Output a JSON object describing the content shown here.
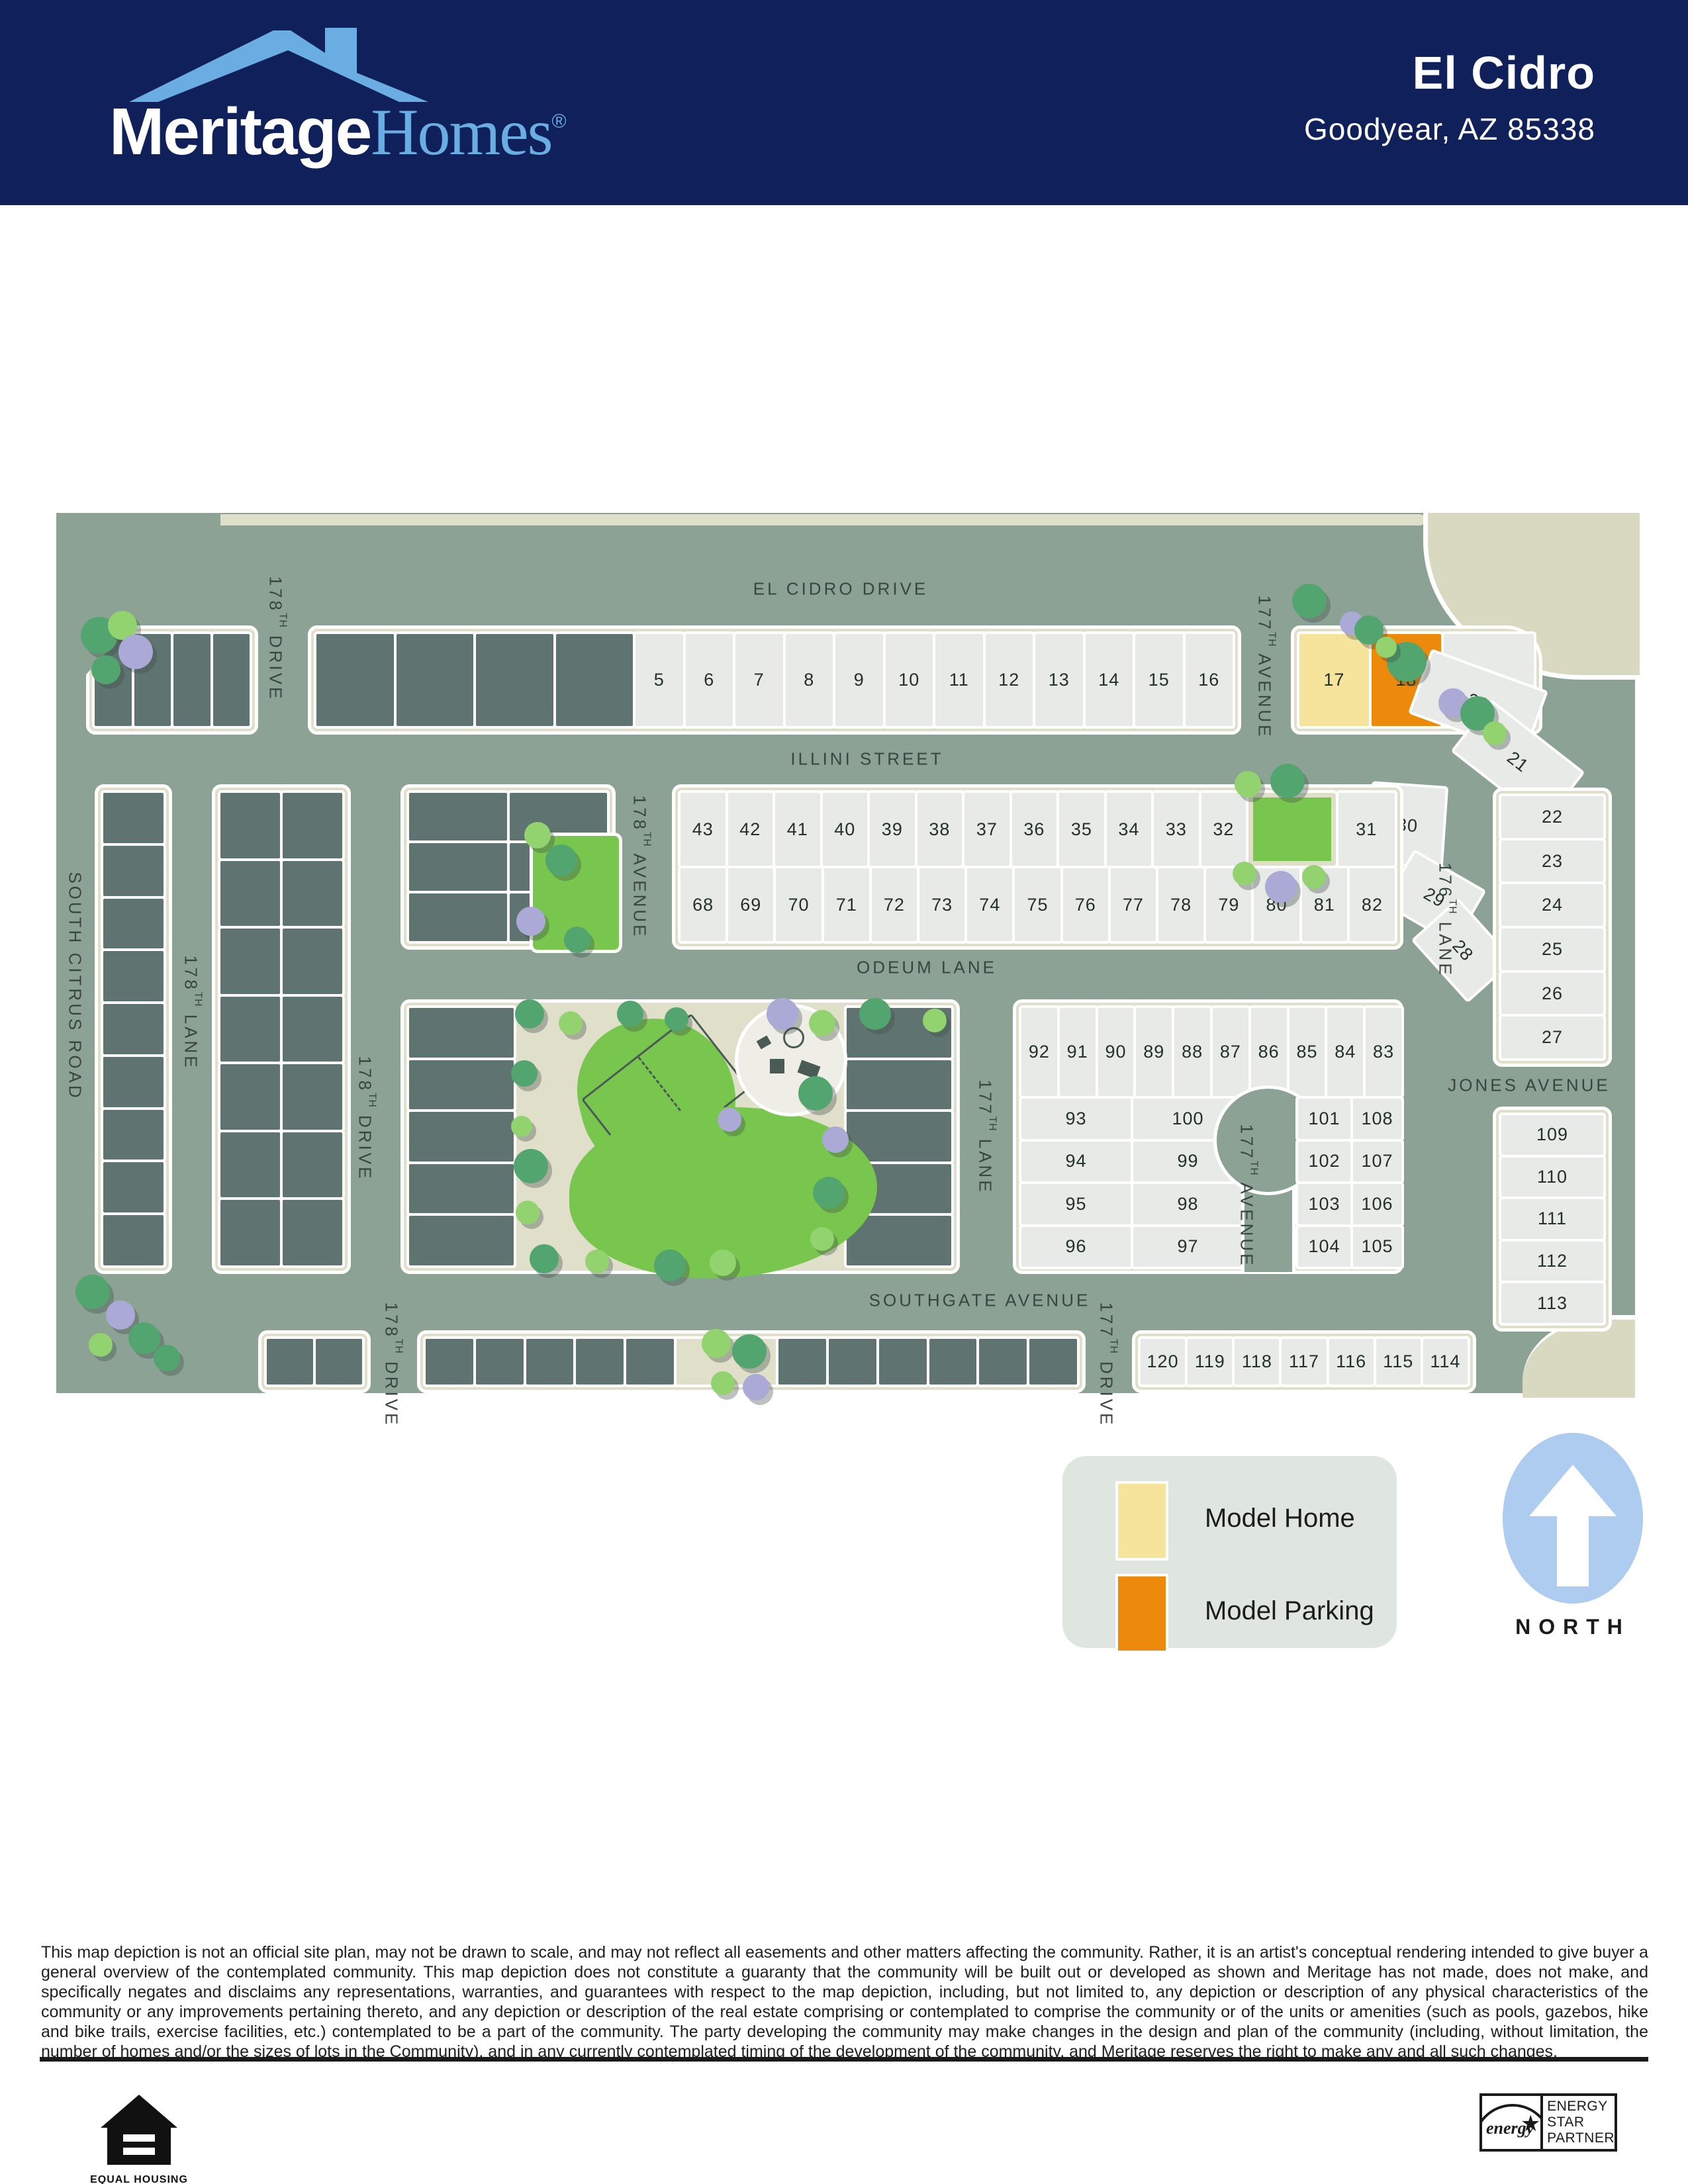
{
  "header": {
    "brand": {
      "word1": "Meritage",
      "word2": "Homes",
      "registered": "®"
    },
    "community": "El Cidro",
    "location": "Goodyear, AZ 85338"
  },
  "map": {
    "streets": {
      "el_cidro": "EL CIDRO DRIVE",
      "illini": "ILLINI STREET",
      "odeum": "ODEUM LANE",
      "southgate": "SOUTHGATE AVENUE",
      "jones": "JONES AVENUE",
      "citrus": "SOUTH CITRUS ROAD",
      "drive178": {
        "pre": "178",
        "sup": "TH",
        "post": " DRIVE"
      },
      "lane178": {
        "pre": "178",
        "sup": "TH",
        "post": " LANE"
      },
      "ave178": {
        "pre": "178",
        "sup": "TH",
        "post": " AVENUE"
      },
      "ave177": {
        "pre": "177",
        "sup": "TH",
        "post": " AVENUE"
      },
      "lane177": {
        "pre": "177",
        "sup": "TH",
        "post": " LANE"
      },
      "lane176": {
        "pre": "176",
        "sup": "TH",
        "post": " LANE"
      },
      "drive177": {
        "pre": "177",
        "sup": "TH",
        "post": " DRIVE"
      }
    },
    "lots": {
      "row_5_16": [
        "5",
        "6",
        "7",
        "8",
        "9",
        "10",
        "11",
        "12",
        "13",
        "14",
        "15",
        "16"
      ],
      "model_row": [
        {
          "n": "17",
          "type": "model"
        },
        {
          "n": "18",
          "type": "parking"
        },
        {
          "n": "19",
          "type": "wider"
        }
      ],
      "fan_20_21": [
        "20",
        "21"
      ],
      "ne_cluster": [
        "30",
        "29",
        "28"
      ],
      "row_43_32": [
        "43",
        "42",
        "41",
        "40",
        "39",
        "38",
        "37",
        "36",
        "35",
        "34",
        "33",
        "32"
      ],
      "lot_31": "31",
      "row_68_82": [
        "68",
        "69",
        "70",
        "71",
        "72",
        "73",
        "74",
        "75",
        "76",
        "77",
        "78",
        "79",
        "80",
        "81",
        "82"
      ],
      "row_92_83": [
        "92",
        "91",
        "90",
        "89",
        "88",
        "87",
        "86",
        "85",
        "84",
        "83"
      ],
      "col_93_96": [
        "93",
        "94",
        "95",
        "96"
      ],
      "col_100_97": [
        "100",
        "99",
        "98",
        "97"
      ],
      "col_101_104": [
        "101",
        "102",
        "103",
        "104"
      ],
      "col_108_105": [
        "108",
        "107",
        "106",
        "105"
      ],
      "col_22_27": [
        "22",
        "23",
        "24",
        "25",
        "26",
        "27"
      ],
      "col_109_113": [
        "109",
        "110",
        "111",
        "112",
        "113"
      ],
      "row_120_114": [
        "120",
        "119",
        "118",
        "117",
        "116",
        "115",
        "114"
      ]
    },
    "legend": {
      "model_home": "Model Home",
      "model_parking": "Model Parking",
      "colors": {
        "model_home": "#F6E39C",
        "model_parking": "#EE8A0B"
      }
    },
    "north_label": "NORTH"
  },
  "disclaimer": "This map depiction is not an official site plan, may not be drawn to scale, and may not reflect all easements and other matters affecting the community. Rather, it is an artist's conceptual rendering intended to give buyer a general overview of the contemplated community. This map depiction does not constitute a guaranty that the community will be built out or developed as shown and Meritage has not made, does not make, and specifically negates and disclaims any representations, warranties, and guarantees with respect to the map depiction, including, but not limited to, any depiction or description of any physical characteristics of the community or any improvements pertaining thereto, and any depiction or description of the real estate comprising or contemplated to comprise the community or of the units or amenities (such as pools, gazebos, hike and bike trails, exercise facilities, etc.) contemplated to be a part of the community. The party developing the community may make changes in the design and plan of the community (including, without limitation, the number of homes and/or the sizes of lots in the Community), and in any currently contemplated timing of the development of the community, and Meritage reserves the right to make any and all such changes.",
  "footer": {
    "equal_housing": {
      "line1": "EQUAL HOUSING",
      "line2": "OPPORTUNITY"
    },
    "energy_star": {
      "script": "energy",
      "star": "★",
      "lines": [
        "ENERGY",
        "STAR",
        "PARTNER"
      ]
    }
  }
}
